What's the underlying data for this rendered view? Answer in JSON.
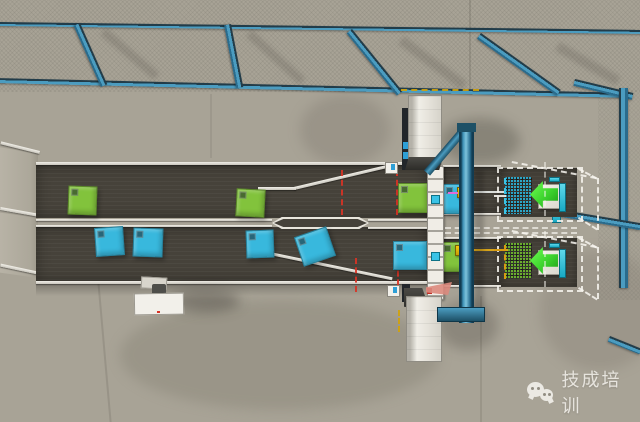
{
  "watermark": {
    "icon": "wechat-icon",
    "text": "技成培训"
  },
  "colors": {
    "floor": "#a8a396",
    "wall": "#a19c8e",
    "belt": "#46423a",
    "rail_white": "#e2dfd6",
    "beam_blue": "#3e8db2",
    "box_green": "#82c33c",
    "box_blue": "#38b8dd",
    "pusher_yellow": "#f3c90f",
    "arrow_green": "#3ed42e",
    "sensor_red": "#d93325",
    "beam_sensor_yellow": "#d8a51b",
    "dash_cyan": "#3ac3e6",
    "dash_orange": "#d89b12",
    "wireframe": "#f6f4ee",
    "pile_blue": "#2bb9e2",
    "pile_green": "#74c22f"
  },
  "scene": {
    "boxes": [
      {
        "lane": "top",
        "color": "green",
        "x": 68,
        "y": 186,
        "w": 27,
        "h": 27,
        "rot": 2
      },
      {
        "lane": "top",
        "color": "green",
        "x": 236,
        "y": 189,
        "w": 27,
        "h": 26,
        "rot": 3
      },
      {
        "lane": "top",
        "color": "green",
        "x": 398,
        "y": 183,
        "w": 28,
        "h": 28,
        "rot": 0
      },
      {
        "lane": "top",
        "color": "blue",
        "x": 443,
        "y": 184,
        "w": 25,
        "h": 28,
        "rot": 0
      },
      {
        "lane": "bottom",
        "color": "blue",
        "x": 95,
        "y": 227,
        "w": 27,
        "h": 27,
        "rot": -4
      },
      {
        "lane": "bottom",
        "color": "blue",
        "x": 133,
        "y": 228,
        "w": 28,
        "h": 27,
        "rot": 2
      },
      {
        "lane": "bottom",
        "color": "blue",
        "x": 246,
        "y": 230,
        "w": 26,
        "h": 26,
        "rot": -2
      },
      {
        "lane": "bottom",
        "color": "blue",
        "x": 298,
        "y": 231,
        "w": 32,
        "h": 29,
        "rot": -19
      },
      {
        "lane": "bottom",
        "color": "blue",
        "x": 393,
        "y": 241,
        "w": 32,
        "h": 27,
        "rot": 0
      },
      {
        "lane": "bottom",
        "color": "green",
        "x": 441,
        "y": 242,
        "w": 28,
        "h": 28,
        "rot": 0
      }
    ],
    "pushers": [
      {
        "lane": "top",
        "target_color": "blue"
      },
      {
        "lane": "bottom",
        "target_color": "green"
      }
    ],
    "receivers": [
      {
        "position": "top",
        "pile": "blue"
      },
      {
        "position": "bottom",
        "pile": "green"
      }
    ]
  }
}
